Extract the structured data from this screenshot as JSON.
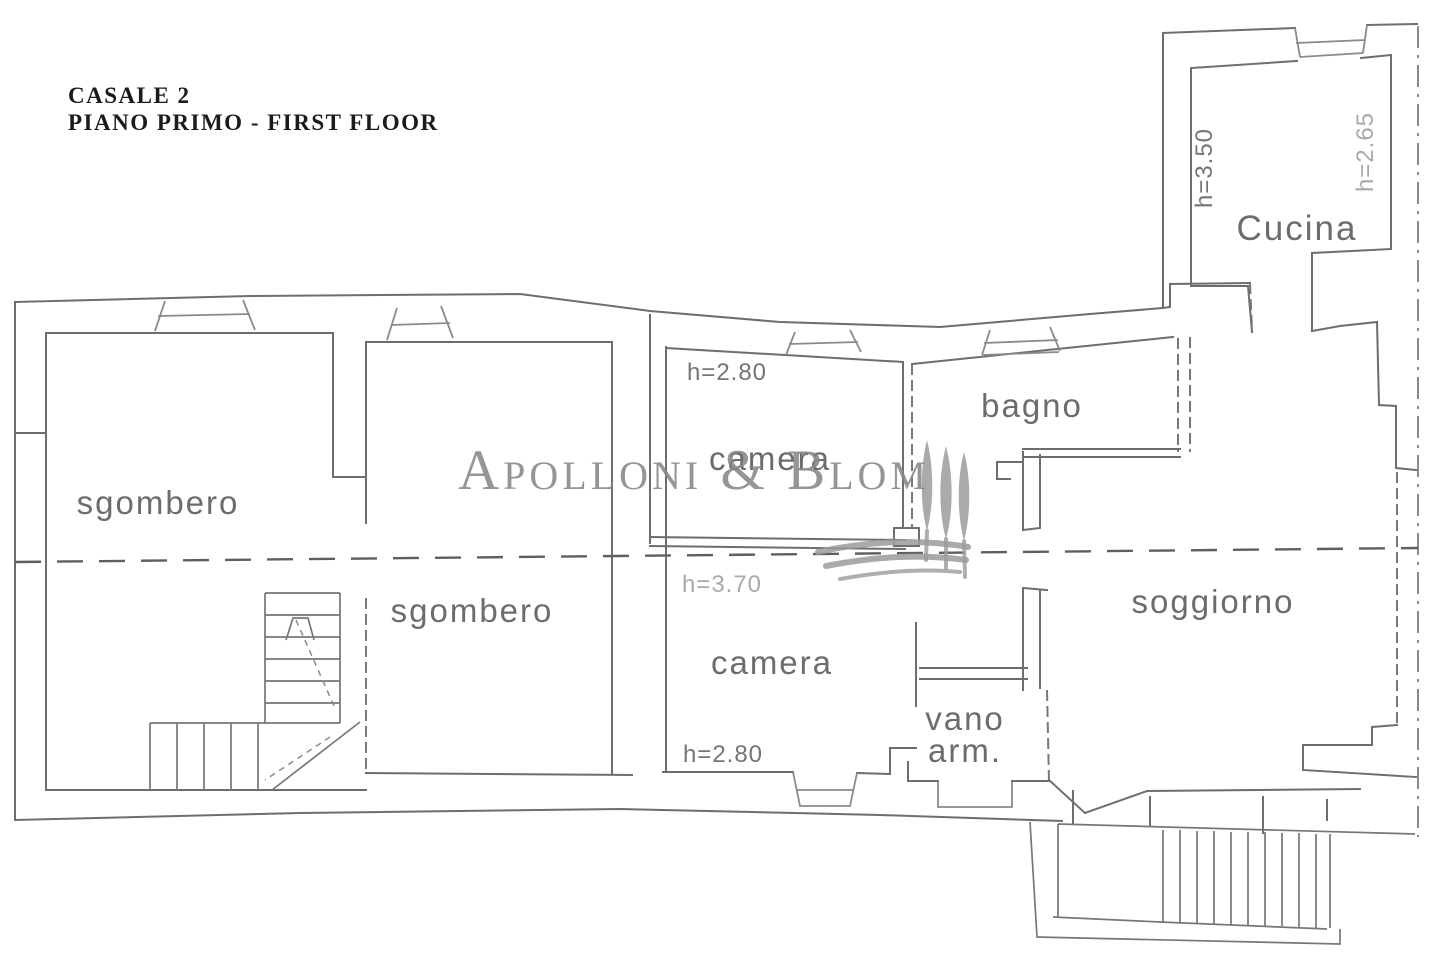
{
  "title": {
    "line1": "CASALE 2",
    "line2": "PIANO PRIMO - FIRST FLOOR"
  },
  "watermark": {
    "brand": "Apolloni & Blom"
  },
  "labels": {
    "sgombero_upper": "sgombero",
    "sgombero_lower": "sgombero",
    "camera_upper": "camera",
    "camera_lower": "camera",
    "bagno": "bagno",
    "soggiorno": "soggiorno",
    "cucina": "Cucina",
    "vano_arm_line1": "vano",
    "vano_arm_line2": "arm."
  },
  "heights": {
    "camera_upper": "h=2.80",
    "camera_lower": "h=2.80",
    "lower_section": "h=3.70",
    "cucina_left": "h=3.50",
    "cucina_right": "h=2.65"
  },
  "colors": {
    "ink": "#6e6e6e",
    "ink_light": "#8a8a8a",
    "title_ink": "#1b1b1b",
    "watermark_gray": "#9b9b9b",
    "background": "#ffffff"
  }
}
